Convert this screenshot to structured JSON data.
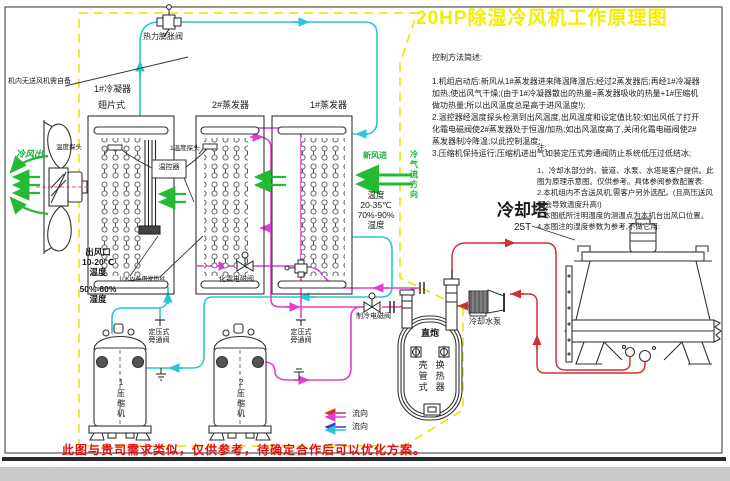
{
  "title": "20HP除湿冷风机工作原理图",
  "control_notes": {
    "heading": "控制方法简述:",
    "body": "1.机组启动后:新风从1#蒸发器进来降温降湿后;经过2蒸发器后;再经1#冷凝器加热,使出风气干燥;(由于1#冷凝器散出的热量=蒸发器吸收的热量+1#压缩机做功热量;所以出风温度总是高于进风温度!);\n2.温控器经温度探头检测到出风温度,出风温度和设定值比较;如出风低了打开化霜电磁阀使2#蒸发器处于恒温/加热;如出风温度高了,关闭化霜电磁阀使2#蒸发器制冷降温;以此控制温度;\n3.压缩机保持运行;压缩机进出气如装定压式旁通阀防止系统低压过低结冰;"
  },
  "side_notes": {
    "heading": "注:",
    "body": "1、冷却水部分的、管道、水泵、水塔是客户提供。此图为原理示意图。仅供参考。具体参阅参数配置表:\n2.本机组内不含送风机,需客户另外选配。(且高压送风机会导致温度升高!)\n3.本图纸所注明温度的测温点为本机台出风口位置。\n4.本图注的湿度参数为参考,不做它用:"
  },
  "labels": {
    "no_fan_note": "机内无送风机需自备",
    "cold_air_out": "冷风出",
    "condenser1": "1#冷凝器",
    "fin_type": "翅片式",
    "evaporator2": "2#蒸发器",
    "evaporator1": "1#蒸发器",
    "thermal_expansion_valve": "热力膨胀阀",
    "temp_probe": "温度探头",
    "temp_probe1": "1温度探头",
    "thermostat": "温控器",
    "backup_heater": "10KW备用发热丝",
    "air_outlet": "出风口\n10-20℃\n温度",
    "outlet_humidity": "50%-60%\n湿度",
    "inlet_conditions": "温度\n20-35℃\n70%-90%\n湿度",
    "fresh_air_in": "新风进",
    "cold_air_flow_direction": "冷气流方向",
    "defrost_solenoid_valve": "化霜电磁阀",
    "cooling_solenoid_valve": "制冷电磁阀",
    "bypass_valve_1": "定压式\n旁通阀",
    "bypass_valve_2": "定压式\n旁通阀",
    "compressor1": "1压缩机",
    "compressor2": "2压缩机",
    "hx_type": "直炮",
    "hx_name_col1": "壳管式",
    "hx_name_col2": "换热器",
    "cooling_water_pump": "冷却水泵",
    "cooling_tower": "冷却塔",
    "tower_capacity": "25T"
  },
  "legend": {
    "flow_red": "流向",
    "flow_blue": "流向"
  },
  "footer_note": "此图与贵司需求类似，仅供参考，待确定合作后可以优化方案。",
  "colors": {
    "pipe_cyan": "#27c7d4",
    "pipe_magenta": "#e23fd2",
    "pipe_red": "#d43030",
    "arrow_green": "#22bb33",
    "boundary_yellow": "#ece400",
    "title_yellow": "#f2ee00",
    "footer_red": "#e01010"
  }
}
